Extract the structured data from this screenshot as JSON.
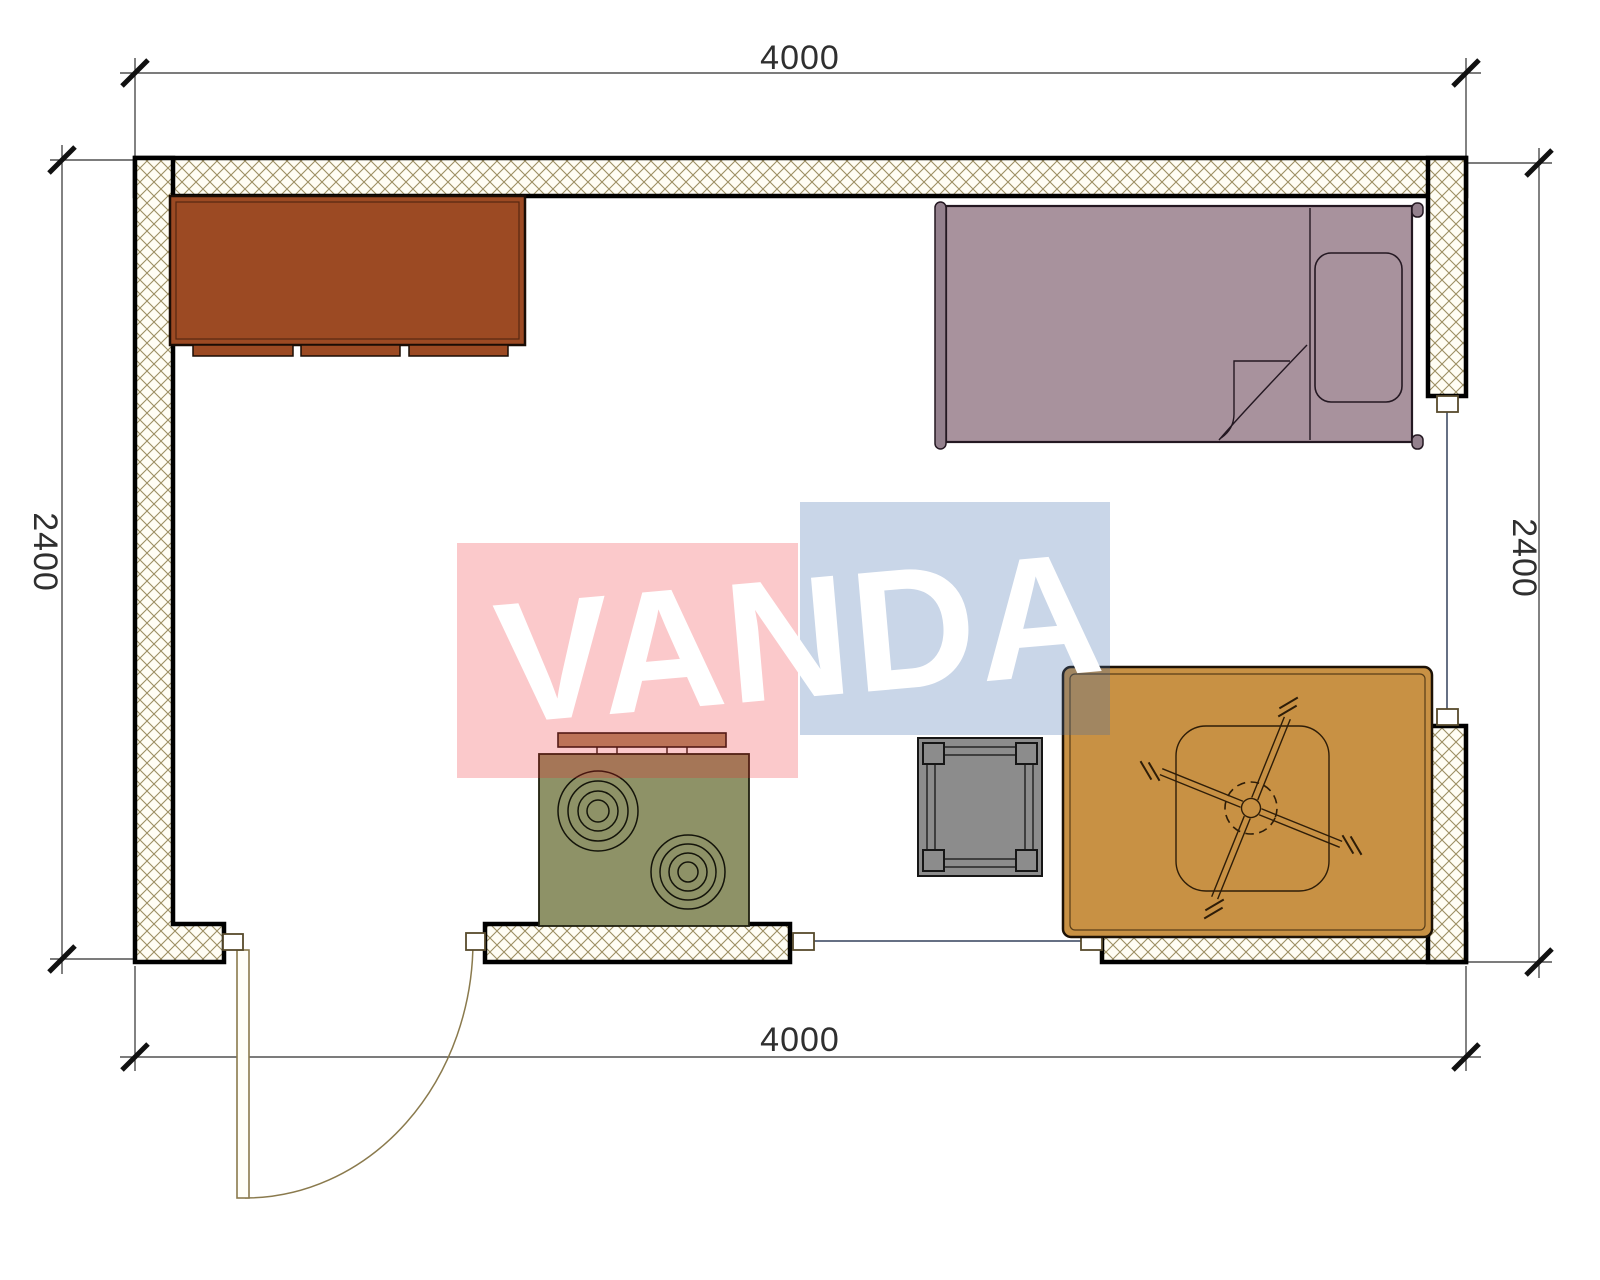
{
  "page": {
    "title": "Room floor plan 4000 x 2400"
  },
  "dimensions": {
    "top": {
      "label": "4000"
    },
    "bottom": {
      "label": "4000"
    },
    "left": {
      "label": "2400"
    },
    "right": {
      "label": "2400"
    }
  },
  "watermark": {
    "text": "VANDA",
    "text_color": "#ffffff",
    "red_square": "rgba(237,28,36,0.24)",
    "blue_square": "rgba(62,108,172,0.28)"
  },
  "colors": {
    "background": "#ffffff",
    "wall_fill": "#fffdf4",
    "wall_hatch": "#9c8e62",
    "wall_border": "#000000",
    "dimension": "#2f2f2f",
    "cabinet": "#9c4a23",
    "cabinet_edge": "#1a0d05",
    "bed": "#a8929d",
    "bed_post": "#93808d",
    "pillow": "#a8929d",
    "stove_body": "#8e9267",
    "stove_shelf": "#ad8e68",
    "table": "#8c8c8c",
    "rug": "#c89144",
    "fan_line": "#2e1d08",
    "glazing": "#33415c",
    "door": "#8a7a4d",
    "jamb_fill": "#ffffff",
    "jamb_edge": "#574a2c"
  }
}
